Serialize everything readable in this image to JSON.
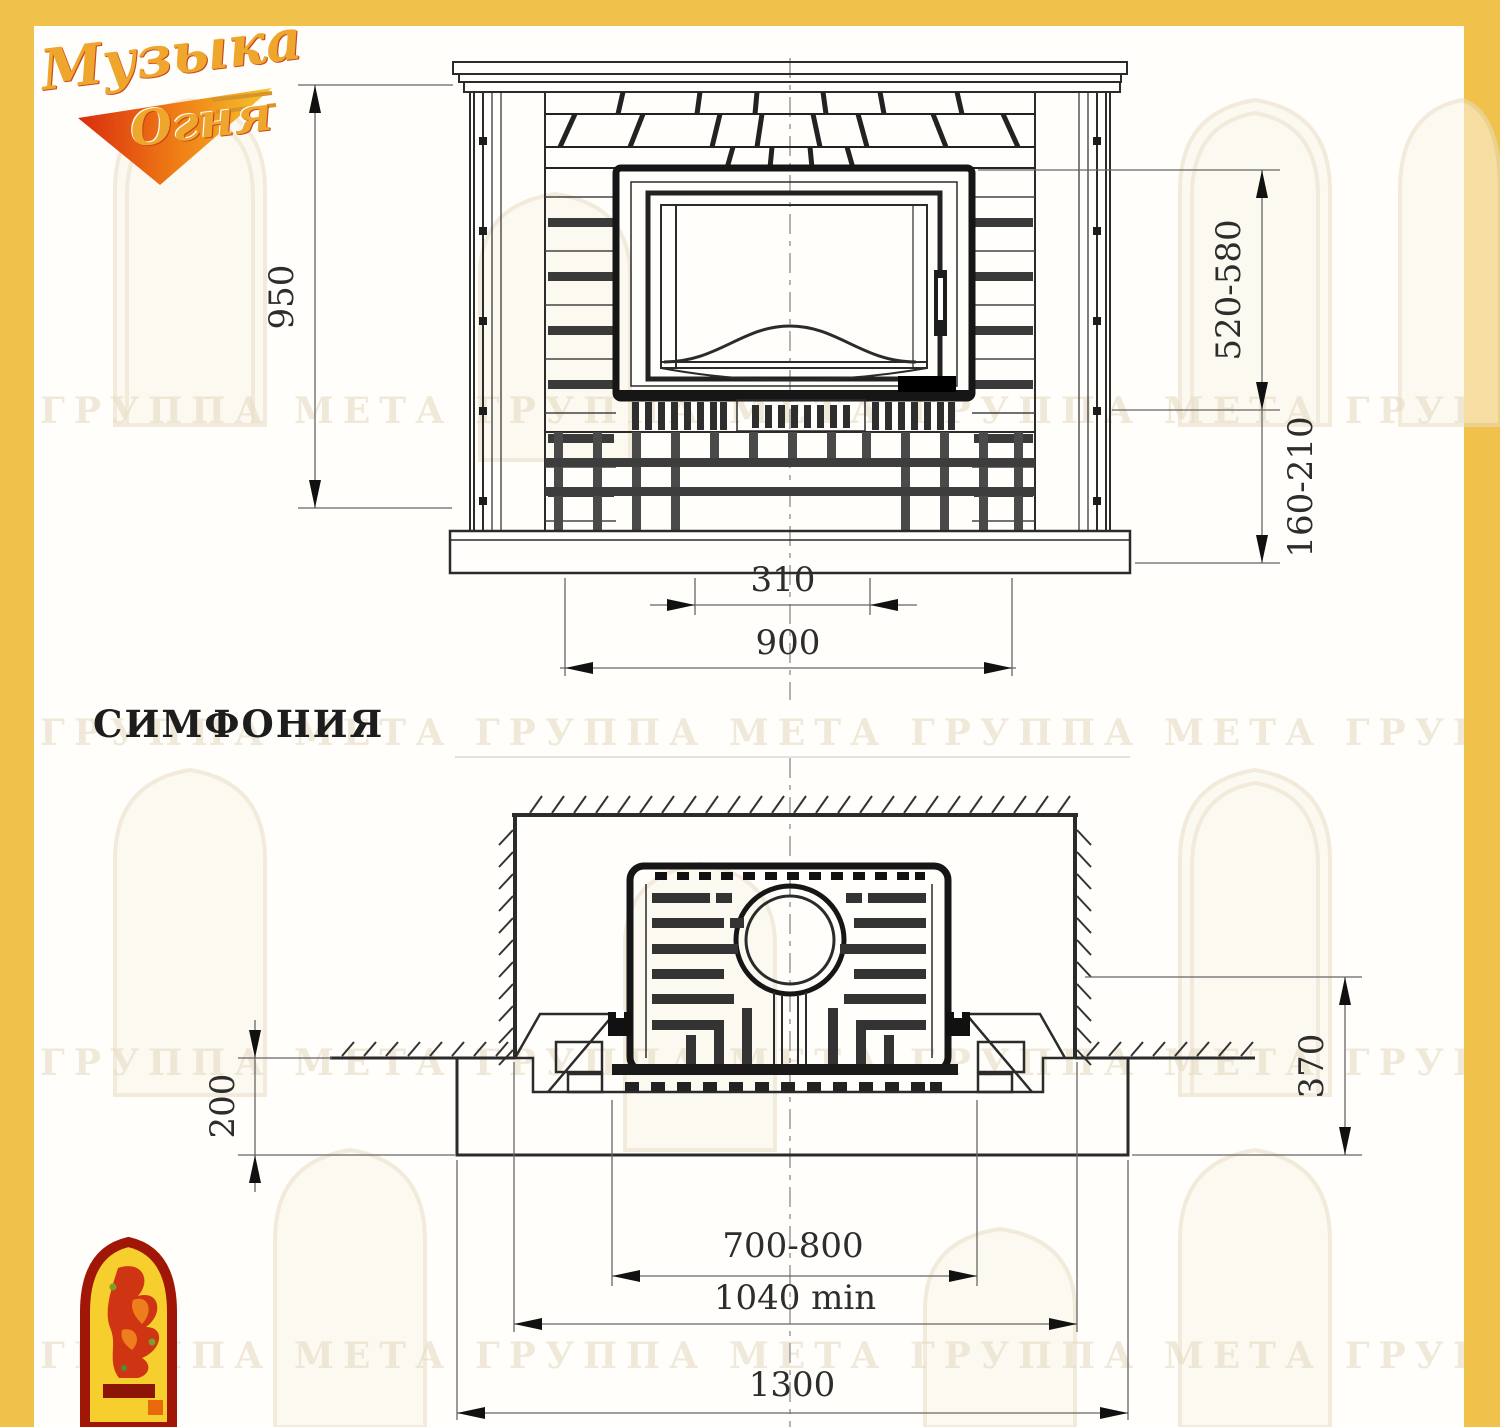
{
  "title": "Fireplace installation drawing",
  "model_name": "СИМФОНИЯ",
  "logo": {
    "brand_line1": "Музыка",
    "brand_line2": "Огня"
  },
  "watermark_text": "ГРУППА МЕТА ГРУППА МЕТА ГРУППА МЕТА ГРУППА МЕТА",
  "colors": {
    "frame": "#f0c14b",
    "line": "#2b2b2b",
    "dim_text": "#2d2d2d",
    "watermark": "#e7dcc4",
    "emblem_red": "#a01708",
    "emblem_yellow": "#f6cf2e"
  },
  "front_view": {
    "dims": {
      "overall_height": "950",
      "firebox_height_range": "520-580",
      "hearth_height_range": "160-210",
      "center_width": "310",
      "body_width": "900"
    }
  },
  "plan_view": {
    "dims": {
      "hearth_projection": "200",
      "front_depth": "370",
      "portal_width": "700-800",
      "niche_width": "1040 min",
      "hearth_width": "1300"
    }
  }
}
